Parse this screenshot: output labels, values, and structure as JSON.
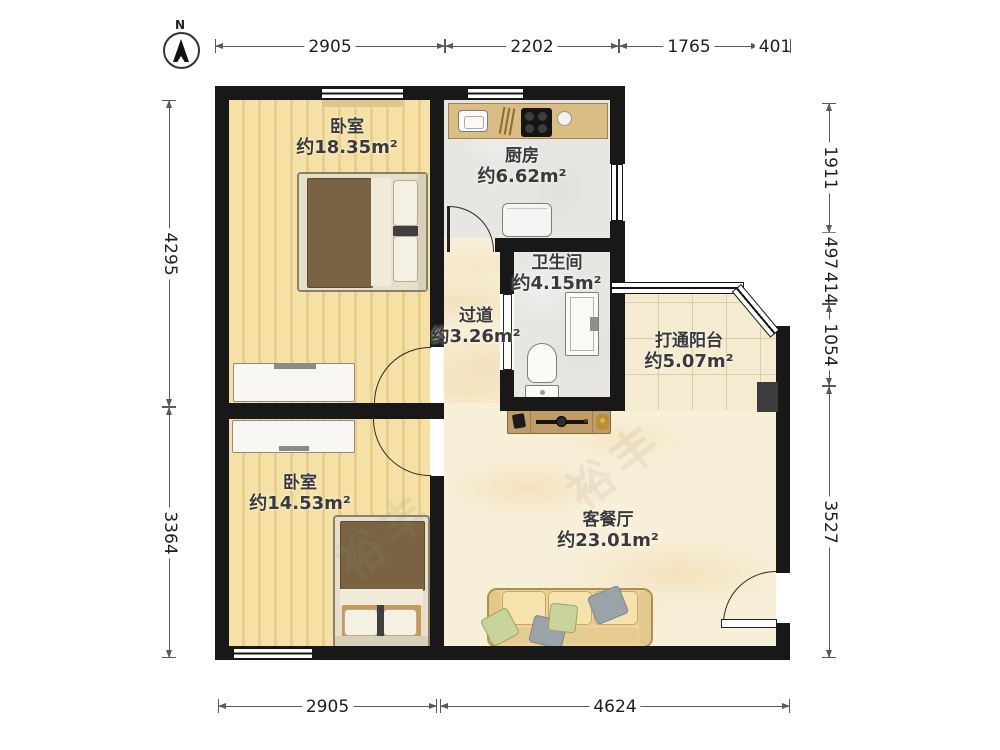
{
  "compass": {
    "label": "N"
  },
  "watermark": "裕丰",
  "rooms": {
    "bedroom1": {
      "name": "卧室",
      "area": "约18.35m²"
    },
    "kitchen": {
      "name": "厨房",
      "area": "约6.62m²"
    },
    "bathroom": {
      "name": "卫生间",
      "area": "约4.15m²"
    },
    "hallway": {
      "name": "过道",
      "area": "约3.26m²"
    },
    "balcony": {
      "name": "打通阳台",
      "area": "约5.07m²"
    },
    "living": {
      "name": "客餐厅",
      "area": "约23.01m²"
    },
    "bedroom2": {
      "name": "卧室",
      "area": "约14.53m²"
    }
  },
  "dimensions": {
    "top": [
      "2905",
      "2202",
      "1765",
      "401"
    ],
    "bottom": [
      "2905",
      "4624"
    ],
    "left": [
      "4295",
      "3364"
    ],
    "right": [
      "1911",
      "497",
      "414",
      "1054",
      "3527"
    ]
  },
  "colors": {
    "wall": "#181818",
    "wood_floor": "#f2dc9e",
    "grey_tile": "#e8e6e3",
    "marble": "#f8efd8",
    "balcony_tile": "#f5ebd1",
    "counter": "#d9bd85",
    "blanket": "#7a6342",
    "sofa": "#ecd29a"
  }
}
